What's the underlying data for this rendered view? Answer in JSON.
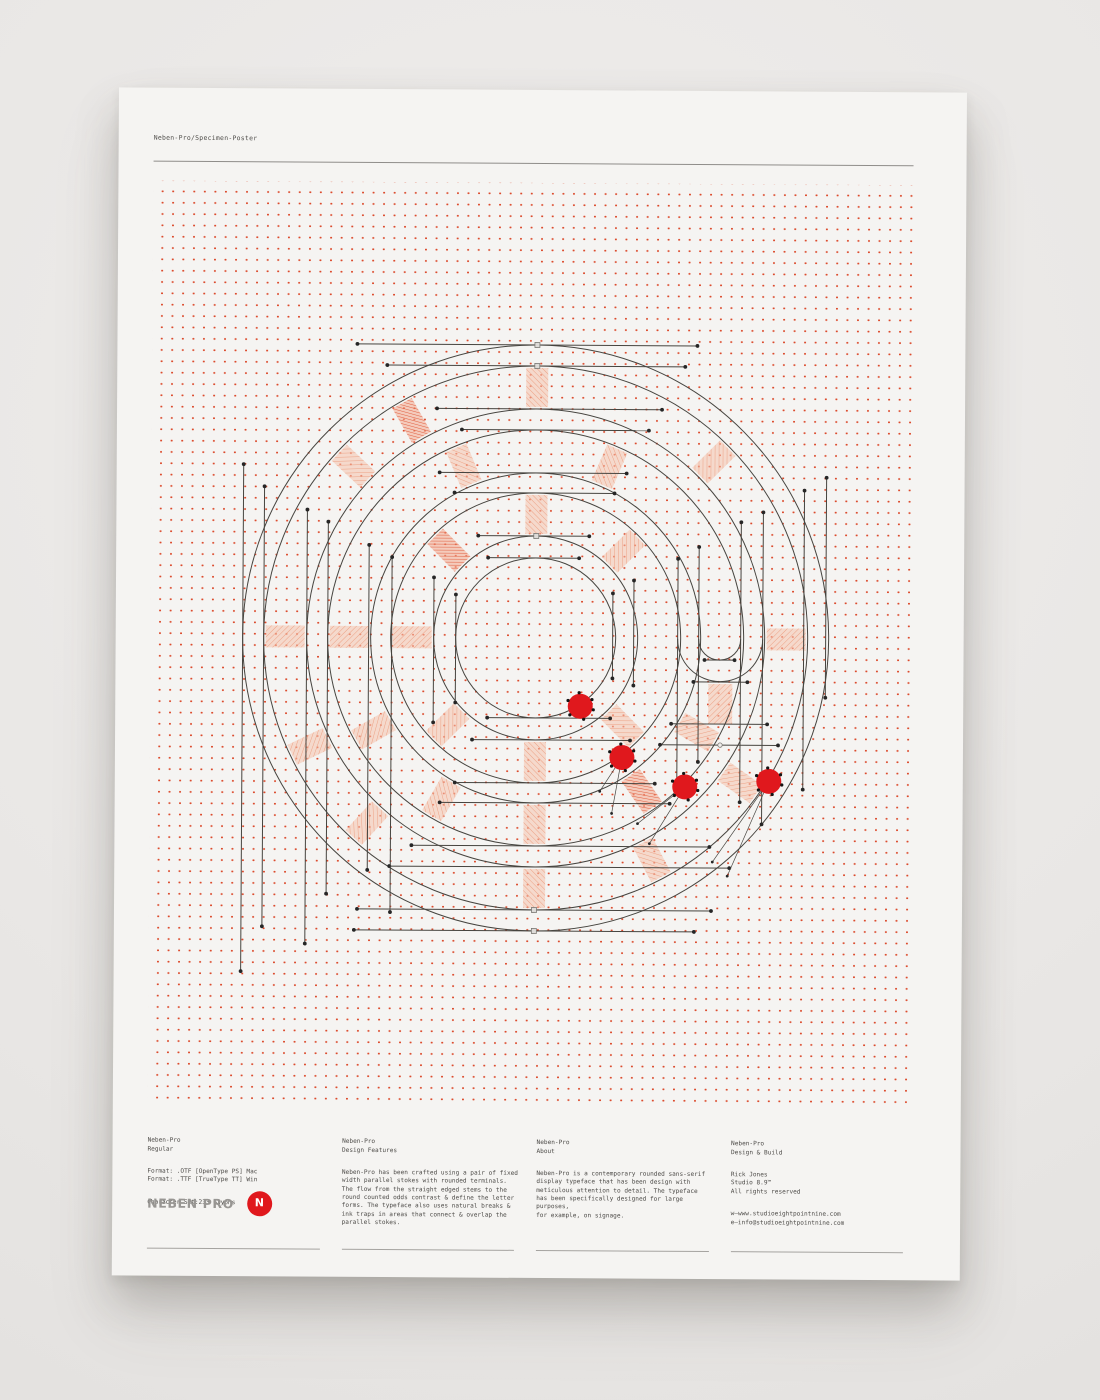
{
  "header": {
    "title": "Neben-Pro/Specimen-Poster"
  },
  "footer": {
    "columns": [
      {
        "heading": "Neben-Pro\nRegular",
        "blocks": [
          "Format: .OTF [OpenType PS] Mac\nFormat: .TTF [TrueType TT] Win",
          "Character Set:233 Glyphs"
        ],
        "logo": {
          "wordmark": "NEBEN PRO",
          "badge": "N"
        }
      },
      {
        "heading": "Neben-Pro\nDesign Features",
        "blocks": [
          "Neben-Pro has been crafted using a pair of fixed\nwidth parallel stokes with rounded terminals.\nThe flow from the straight edged stems to the\nround counted odds contrast & define the letter\nforms. The typeface also uses natural breaks &\nink traps in areas that connect & overlap the\nparallel stokes."
        ]
      },
      {
        "heading": "Neben-Pro\nAbout",
        "blocks": [
          "Neben-Pro is a contemporary rounded sans-serif\ndisplay typeface that has been design with\nmeticulous attention to detail. The typeface\nhas been specifically designed for large purposes,\nfor example, on signage."
        ]
      },
      {
        "heading": "Neben-Pro\nDesign & Build",
        "blocks": [
          "Rick Jones\nStudio 8.9™\nAll rights reserved",
          "w—www.studioeightpointnine.com\ne—info@studioeightpointnine.com"
        ]
      }
    ]
  },
  "colors": {
    "background": "#e9e7e5",
    "paper": "#f5f4f2",
    "grid_dot": "#dc4c2e",
    "ink": "#46443f",
    "accent_red": "#e0181d",
    "rule": "#a5a3a0",
    "text": "#4e4c49",
    "logo_gray": "#989693",
    "spoke_fill": "#f6c2ac",
    "spoke_line": "#eb9878",
    "spoke_dense_fill": "#f3a98f",
    "spoke_dense_line": "#dd4a28",
    "marker_dot": "#262626",
    "marker_square_fill": "#dddbd8",
    "marker_square_stroke": "#7a7873"
  },
  "artwork": {
    "center": {
      "x": 385,
      "y": 455
    },
    "ring_radii": [
      80,
      102,
      145,
      165,
      208,
      229,
      272,
      293
    ],
    "u_arcs": [
      {
        "r": 42.5,
        "x1": 527,
        "x2": 612
      },
      {
        "r": 21,
        "x1": 548,
        "x2": 590
      }
    ],
    "spoke_gaps": {
      "A": [
        104,
        143
      ],
      "B": [
        167,
        206
      ],
      "C": [
        231,
        270
      ]
    },
    "spokes": [
      {
        "gap": "A",
        "a": -90
      },
      {
        "gap": "A",
        "a": -45
      },
      {
        "gap": "A",
        "a": -135,
        "dense": true
      },
      {
        "gap": "A",
        "a": 180
      },
      {
        "gap": "A",
        "a": 135
      },
      {
        "gap": "A",
        "a": 90
      },
      {
        "gap": "A",
        "a": 45
      },
      {
        "gap": "B",
        "a": -67
      },
      {
        "gap": "B",
        "a": -113
      },
      {
        "gap": "B",
        "a": 180
      },
      {
        "gap": "B",
        "a": 150
      },
      {
        "gap": "B",
        "a": 90
      },
      {
        "gap": "B",
        "a": 55,
        "dense": true
      },
      {
        "gap": "B",
        "a": 120
      },
      {
        "gap": "B",
        "a": 30
      },
      {
        "gap": "C",
        "a": -90
      },
      {
        "gap": "C",
        "a": -45
      },
      {
        "gap": "C",
        "a": -120,
        "dense": true
      },
      {
        "gap": "C",
        "a": 0
      },
      {
        "gap": "C",
        "a": 180
      },
      {
        "gap": "C",
        "a": -137
      },
      {
        "gap": "C",
        "a": 154
      },
      {
        "gap": "C",
        "a": 132
      },
      {
        "gap": "C",
        "a": 90
      },
      {
        "gap": "C",
        "a": 35
      },
      {
        "gap": "C",
        "a": 62
      }
    ],
    "extra_spoke_rects": [
      {
        "x": 558,
        "y": 500,
        "w": 24,
        "h": 40
      }
    ],
    "hlines": [
      {
        "y": 162,
        "x1": 205,
        "x2": 545,
        "sq": true
      },
      {
        "y": 183,
        "x1": 235,
        "x2": 533,
        "sq": true
      },
      {
        "y": 226,
        "x1": 285,
        "x2": 510
      },
      {
        "y": 247,
        "x1": 310,
        "x2": 497
      },
      {
        "y": 290,
        "x1": 288,
        "x2": 475
      },
      {
        "y": 310,
        "x1": 303,
        "x2": 463
      },
      {
        "y": 353,
        "x1": 327,
        "x2": 438,
        "sq": true
      },
      {
        "y": 375,
        "x1": 337,
        "x2": 428
      },
      {
        "y": 535,
        "x1": 337,
        "x2": 460
      },
      {
        "y": 557,
        "x1": 322,
        "x2": 480
      },
      {
        "y": 600,
        "x1": 305,
        "x2": 505
      },
      {
        "y": 620,
        "x1": 290,
        "x2": 520
      },
      {
        "y": 663,
        "x1": 262,
        "x2": 560
      },
      {
        "y": 684,
        "x1": 240,
        "x2": 580
      },
      {
        "y": 727,
        "x1": 208,
        "x2": 562,
        "sq": true
      },
      {
        "y": 748,
        "x1": 205,
        "x2": 545,
        "sq": true
      },
      {
        "y": 476,
        "x1": 554,
        "x2": 584
      },
      {
        "y": 498,
        "x1": 543,
        "x2": 597
      },
      {
        "y": 540,
        "x1": 521,
        "x2": 617
      },
      {
        "y": 561,
        "x1": 510,
        "x2": 628,
        "mk": "o",
        "mx": 570
      }
    ],
    "vlines": [
      {
        "x": 92,
        "y1": 283,
        "y2": 790
      },
      {
        "x": 113,
        "y1": 305,
        "y2": 745
      },
      {
        "x": 156,
        "y1": 328,
        "y2": 762
      },
      {
        "x": 177,
        "y1": 340,
        "y2": 712
      },
      {
        "x": 218,
        "y1": 363,
        "y2": 688
      },
      {
        "x": 241,
        "y1": 375,
        "y2": 730
      },
      {
        "x": 283,
        "y1": 395,
        "y2": 540
      },
      {
        "x": 305,
        "y1": 412,
        "y2": 520
      },
      {
        "x": 462,
        "y1": 410,
        "y2": 495
      },
      {
        "x": 483,
        "y1": 397,
        "y2": 502
      },
      {
        "x": 527,
        "y1": 375,
        "y2": 600
      },
      {
        "x": 548,
        "y1": 363,
        "y2": 578
      },
      {
        "x": 590,
        "y1": 338,
        "y2": 618
      },
      {
        "x": 612,
        "y1": 328,
        "y2": 640
      },
      {
        "x": 653,
        "y1": 306,
        "y2": 605
      },
      {
        "x": 675,
        "y1": 293,
        "y2": 513
      }
    ],
    "red_dots": [
      {
        "x": 430,
        "y": 523
      },
      {
        "x": 472,
        "y": 574
      },
      {
        "x": 535,
        "y": 603
      },
      {
        "x": 619,
        "y": 597
      }
    ],
    "leader_lines": [
      [
        472,
        574,
        450,
        608
      ],
      [
        472,
        574,
        462,
        630
      ],
      [
        535,
        603,
        488,
        640
      ],
      [
        535,
        603,
        500,
        660
      ],
      [
        619,
        597,
        563,
        678
      ],
      [
        619,
        597,
        578,
        692
      ]
    ]
  }
}
